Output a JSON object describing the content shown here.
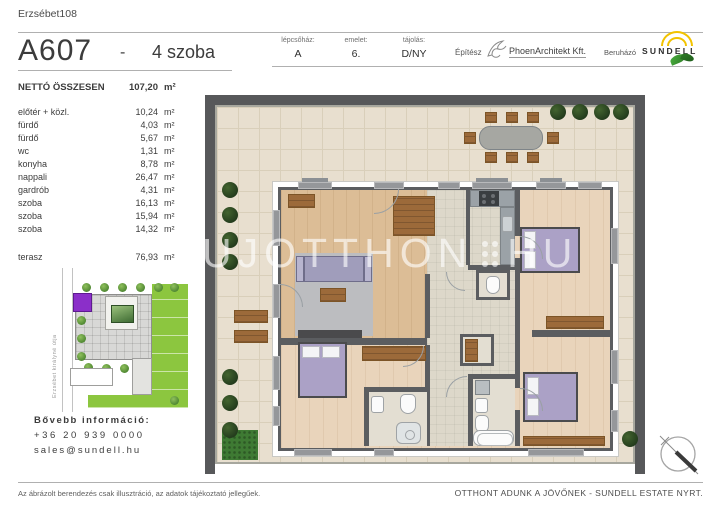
{
  "header": {
    "project": "Erzsébet108",
    "unit_id": "A607",
    "separator": "-",
    "unit_type": "4 szoba",
    "fields": [
      {
        "label": "lépcsőház:",
        "value": "A"
      },
      {
        "label": "emelet:",
        "value": "6."
      },
      {
        "label": "tájolás:",
        "value": "D/NY"
      }
    ],
    "architect_label": "Építész",
    "architect_name": "PhoenArchitekt Kft.",
    "developer_label": "Beruházó",
    "developer_name": "SUNDELL"
  },
  "areas": {
    "total_label": "NETTÓ ÖSSZESEN",
    "total_value": "107,20",
    "unit": "m²",
    "rooms": [
      {
        "name": "előtér + közl.",
        "value": "10,24"
      },
      {
        "name": "fürdő",
        "value": "4,03"
      },
      {
        "name": "fürdő",
        "value": "5,67"
      },
      {
        "name": "wc",
        "value": "1,31"
      },
      {
        "name": "konyha",
        "value": "8,78"
      },
      {
        "name": "nappali",
        "value": "26,47"
      },
      {
        "name": "gardrób",
        "value": "4,31"
      },
      {
        "name": "szoba",
        "value": "16,13"
      },
      {
        "name": "szoba",
        "value": "15,94"
      },
      {
        "name": "szoba",
        "value": "14,32"
      }
    ],
    "terrace_name": "terasz",
    "terrace_value": "76,93"
  },
  "sitemap": {
    "street_name": "Erzsébet királyné útja"
  },
  "contact": {
    "heading": "Bővebb információ:",
    "phone": "+36 20 939 0000",
    "email": "sales@sundell.hu"
  },
  "watermark": {
    "left": "UJOTTHON",
    "right": "HU"
  },
  "footer": {
    "disclaimer": "Az ábrázolt berendezés csak illusztráció, az adatok tájékoztató jellegűek.",
    "slogan": "OTTHONT ADUNK A JÖVŐNEK - SUNDELL ESTATE NYRT."
  },
  "colors": {
    "brand_yellow": "#f2c300",
    "brand_green": "#3f9c35",
    "highlight_unit_purple": "#8b2fc9",
    "bed_lavender": "#aba1c6",
    "terrace_tile": "#e8dfcf",
    "wall_dark": "#57585a"
  }
}
